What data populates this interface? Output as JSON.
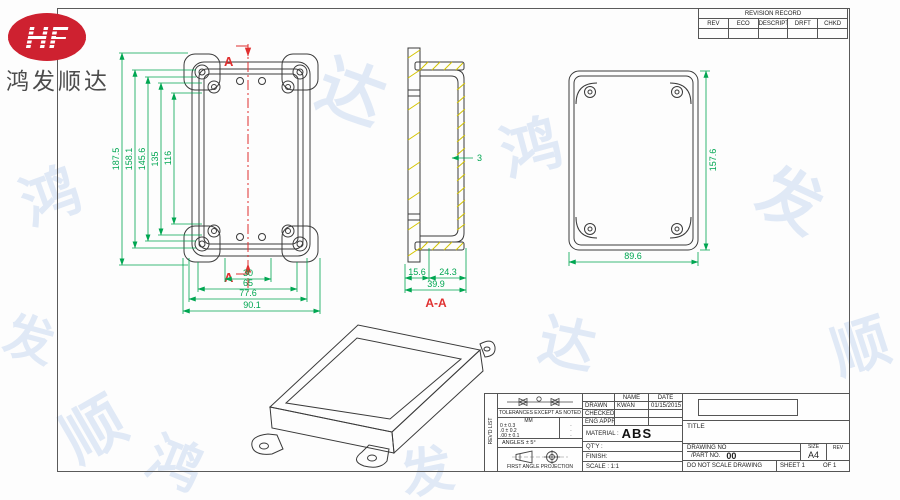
{
  "logo": {
    "brand": "HF",
    "company": "鸿发顺达"
  },
  "watermark": {
    "text": "鸿",
    "text2": "发",
    "text3": "顺",
    "text4": "达"
  },
  "revision_table": {
    "title": "REVISION RECORD",
    "columns": [
      "REV",
      "ECO",
      "DESCRIPTION",
      "DRFT",
      "CHKD"
    ]
  },
  "front": {
    "section_label": "A",
    "dims_v": [
      "187.5",
      "158.1",
      "145.6",
      "135",
      "116"
    ],
    "dims_h": [
      "30",
      "65",
      "77.6",
      "90.1"
    ]
  },
  "section": {
    "label": "A-A",
    "wall": "3",
    "dims_bottom": [
      "15.6",
      "24.3"
    ],
    "dim_total": "39.9"
  },
  "back": {
    "dim_h": "157.6",
    "dim_w": "89.6"
  },
  "title_block": {
    "side_label": "REV'D LIST",
    "tolerances_header": "TOLERANCES EXCEPT AS NOTED",
    "tolerance_unit": "MM",
    "tolerance_rows": [
      "0 ± 0.3",
      ".0 ± 0.2",
      ".00 ± 0.1"
    ],
    "tolerance_marks": [
      "·",
      "·",
      "·"
    ],
    "angles": "ANGLES ± 5°",
    "projection": "FIRST ANGLE PROJECTION",
    "name_header": "NAME",
    "date_header": "DATE",
    "drawn_label": "DRAWN",
    "drawn_name": "KWAN",
    "drawn_date": "01/15/2015",
    "checked_label": "CHECKED",
    "eng_appr_label": "ENG APPR",
    "material_label": "MATERIAL :",
    "material_value": "ABS",
    "qty_label": "QT'Y :",
    "finish_label": "FINISH:",
    "scale_label": "SCALE : 1:1",
    "title_label": "TITLE",
    "drawing_no_label": "DRAWING NO",
    "part_no_label": "/PART  NO.",
    "part_no_value": "00",
    "size_label": "SIZE",
    "size_value": "A4",
    "rev_label": "REV",
    "no_scale": "DO NOT SCALE DRAWING",
    "sheet_label": "SHEET 1",
    "of_label": "OF 1"
  },
  "colors": {
    "dimension": "#00a651",
    "section_mark": "#e03030",
    "hatch": "#d4c400",
    "logo_red": "#ce2130"
  }
}
